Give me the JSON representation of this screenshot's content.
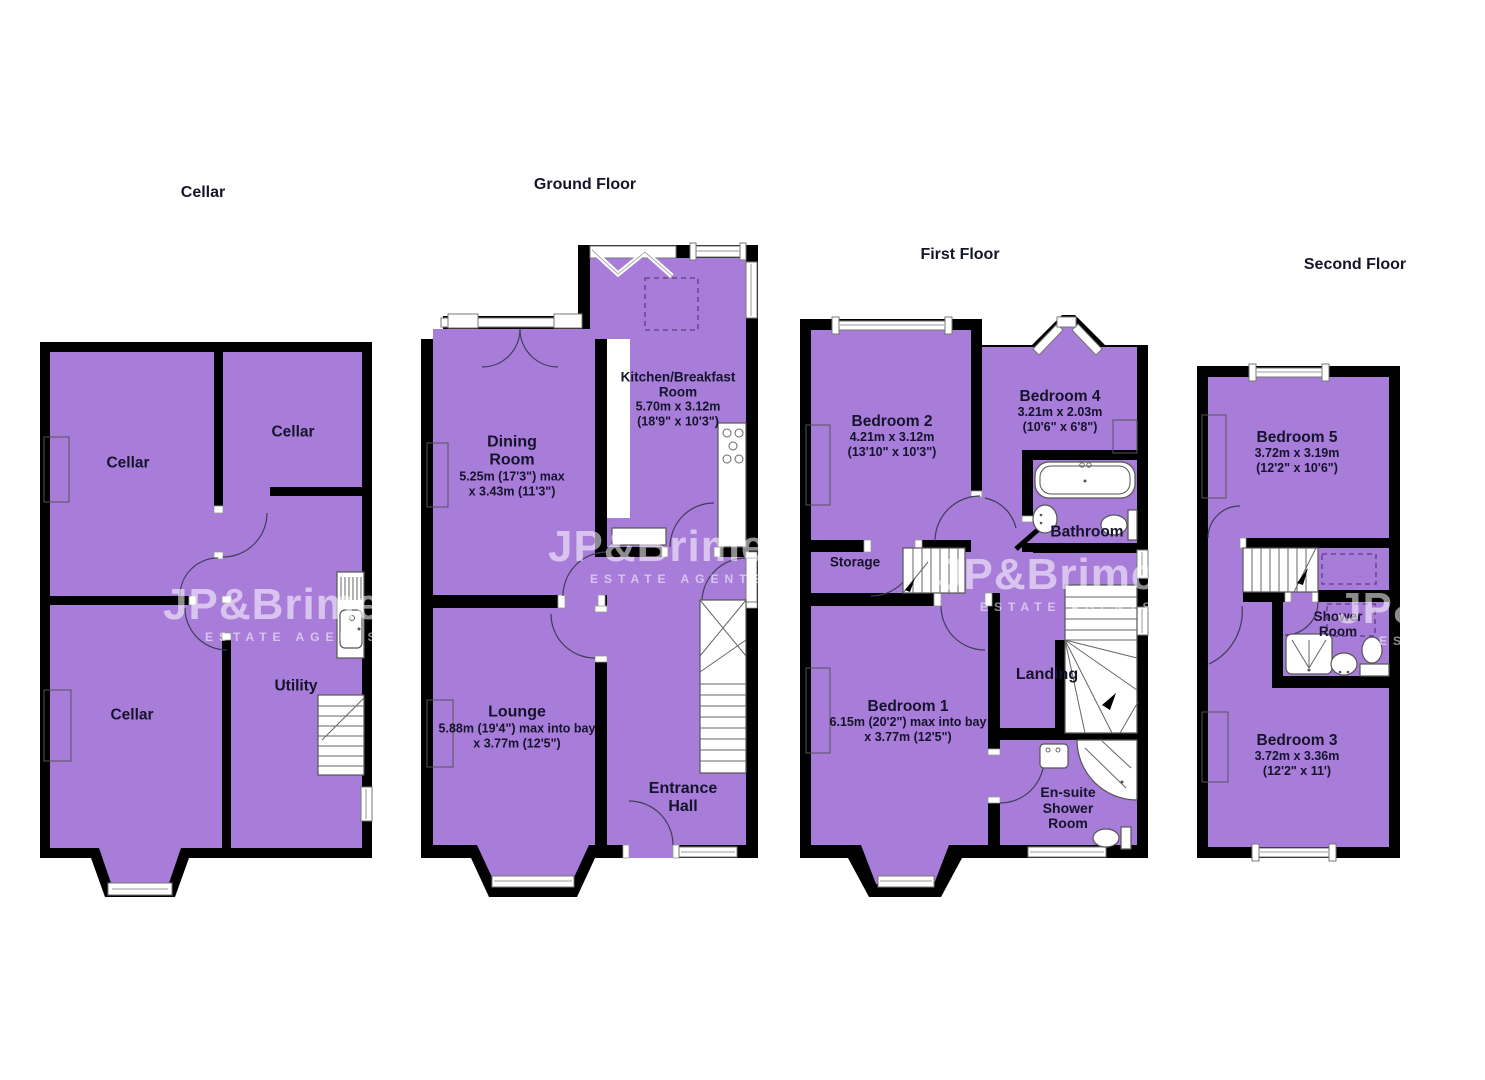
{
  "colors": {
    "room_fill": "#a87cd9",
    "wall": "#000000",
    "label_text": "#14142b",
    "watermark": "rgba(255,255,255,0.55)"
  },
  "watermark": {
    "name": "JP&Brimelow",
    "tagline": "ESTATE AGENTS"
  },
  "floors": {
    "cellar": {
      "title": "Cellar",
      "rooms": {
        "cellar_top_left": {
          "name": "Cellar"
        },
        "cellar_top_right": {
          "name": "Cellar"
        },
        "cellar_bottom_left": {
          "name": "Cellar"
        },
        "utility": {
          "name": "Utility"
        }
      }
    },
    "ground": {
      "title": "Ground Floor",
      "rooms": {
        "kitchen": {
          "name": "Kitchen/Breakfast Room",
          "dims1": "5.70m x 3.12m",
          "dims2": "(18'9\" x 10'3\")"
        },
        "dining": {
          "name": "Dining Room",
          "dims1": "5.25m (17'3\") max",
          "dims2": "x 3.43m (11'3\")"
        },
        "lounge": {
          "name": "Lounge",
          "dims1": "5.88m (19'4\") max into bay",
          "dims2": "x 3.77m (12'5\")"
        },
        "entrance_hall": {
          "name": "Entrance Hall"
        }
      }
    },
    "first": {
      "title": "First Floor",
      "rooms": {
        "bedroom2": {
          "name": "Bedroom 2",
          "dims1": "4.21m x 3.12m",
          "dims2": "(13'10\" x 10'3\")"
        },
        "bedroom4": {
          "name": "Bedroom 4",
          "dims1": "3.21m x 2.03m",
          "dims2": "(10'6\" x 6'8\")"
        },
        "bathroom": {
          "name": "Bathroom"
        },
        "storage": {
          "name": "Storage"
        },
        "landing": {
          "name": "Landing"
        },
        "bedroom1": {
          "name": "Bedroom 1",
          "dims1": "6.15m (20'2\") max into bay",
          "dims2": "x 3.77m (12'5\")"
        },
        "ensuite": {
          "name": "En-suite Shower Room"
        }
      }
    },
    "second": {
      "title": "Second Floor",
      "rooms": {
        "bedroom5": {
          "name": "Bedroom 5",
          "dims1": "3.72m x 3.19m",
          "dims2": "(12'2\" x 10'6\")"
        },
        "shower_room": {
          "name": "Shower Room"
        },
        "bedroom3": {
          "name": "Bedroom 3",
          "dims1": "3.72m x 3.36m",
          "dims2": "(12'2\" x 11')"
        }
      }
    }
  }
}
